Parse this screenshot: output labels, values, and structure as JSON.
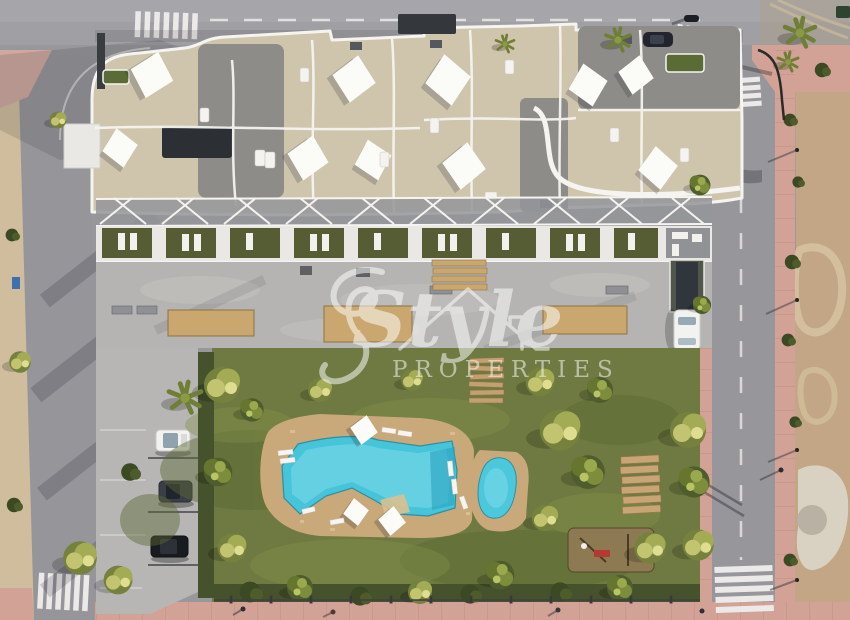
{
  "watermark": {
    "brand_word": "Style",
    "brand_suffix": "PROPERTIES"
  },
  "palette": {
    "asphalt": "#98979b",
    "asphalt_light": "#a6a5a9",
    "sidewalk_pink": "#d2a296",
    "concrete_plaza": "#b5b4b2",
    "roof_tile": "#cfc5ad",
    "roof_gravel": "#8e8c88",
    "parapet_white": "#f5f4f0",
    "terrace_turf": "#565c33",
    "lawn": "#6e7a41",
    "hedge": "#46522c",
    "pool_water": "#45c4da",
    "kids_pool_water": "#4cc8dc",
    "deck_stone": "#c9a87a",
    "planter_sand": "#c9a76e",
    "timber": "#c2a070",
    "sand_verge": "#cfbd9e",
    "dirt": "#c2a685",
    "shade_sail": "#fbfbf8",
    "road_marking": "#e9e9e7",
    "car_white": "#f2f2f0",
    "car_dark": "#3a3e47",
    "car_black": "#181b20",
    "playground_base": "#8d7a52"
  }
}
